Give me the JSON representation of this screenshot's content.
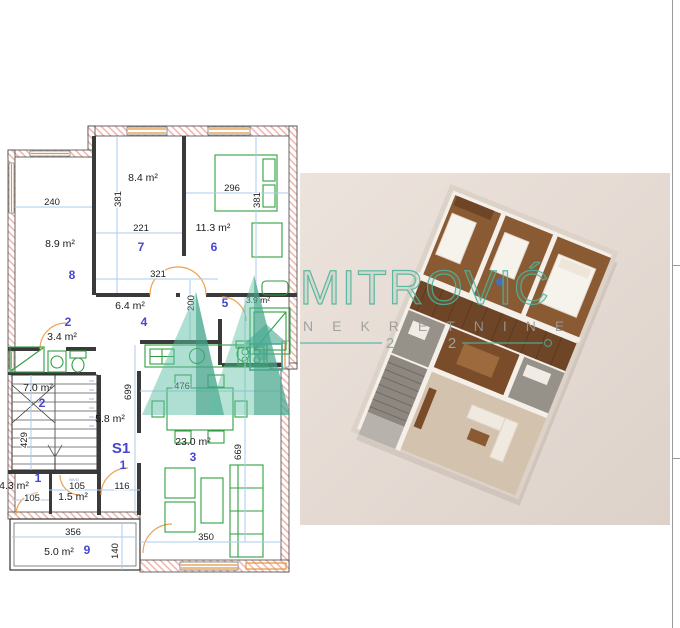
{
  "plan": {
    "rooms": {
      "r7": {
        "num": "7",
        "area": "8.4 m²"
      },
      "r6": {
        "num": "6",
        "area": "11.3 m²"
      },
      "r8": {
        "num": "8",
        "area": "8.9 m²"
      },
      "r2a": {
        "num": "2",
        "area": "3.4 m²"
      },
      "r4": {
        "num": "4",
        "area": "6.4 m²"
      },
      "r5": {
        "num": "5",
        "area": "3.9 m²"
      },
      "r2b": {
        "num": "2",
        "area": "7.0 m²"
      },
      "r3": {
        "num": "3",
        "area": "23.0 m²"
      },
      "r1": {
        "num": "1",
        "area": "4.3 m²"
      },
      "r9": {
        "num": "9",
        "area": "5.0 m²"
      },
      "corridor": {
        "area": "5.8 m²"
      },
      "closet": {
        "area": "1.5 m²"
      }
    },
    "unit": {
      "code": "S1",
      "num": "1"
    },
    "stair_note": "NIVO",
    "dims": {
      "w240": "240",
      "h381l": "381",
      "w221": "221",
      "w296": "296",
      "h381r": "381",
      "w321": "321",
      "h200": "200",
      "w476": "476",
      "h699": "699",
      "h669": "669",
      "h429": "429",
      "w105a": "105",
      "w105b": "105",
      "w116": "116",
      "w356": "356",
      "h140": "140",
      "w350": "350"
    },
    "colors": {
      "wall_hatch": "#f0b8b0",
      "furniture": "#2f9e41",
      "dimension_line": "#aaceec",
      "room_number": "#4646cf",
      "door": "#f0a050",
      "window": "#e8943c"
    }
  },
  "watermark": {
    "brand": "MITROVIĆ",
    "tagline": "NEKRETNINE",
    "year_left": "2",
    "year_right": "2",
    "accent_color": "#4fb39c",
    "tagline_color": "#9a9a9a"
  },
  "render3d": {
    "background": "#e6ddd6"
  }
}
